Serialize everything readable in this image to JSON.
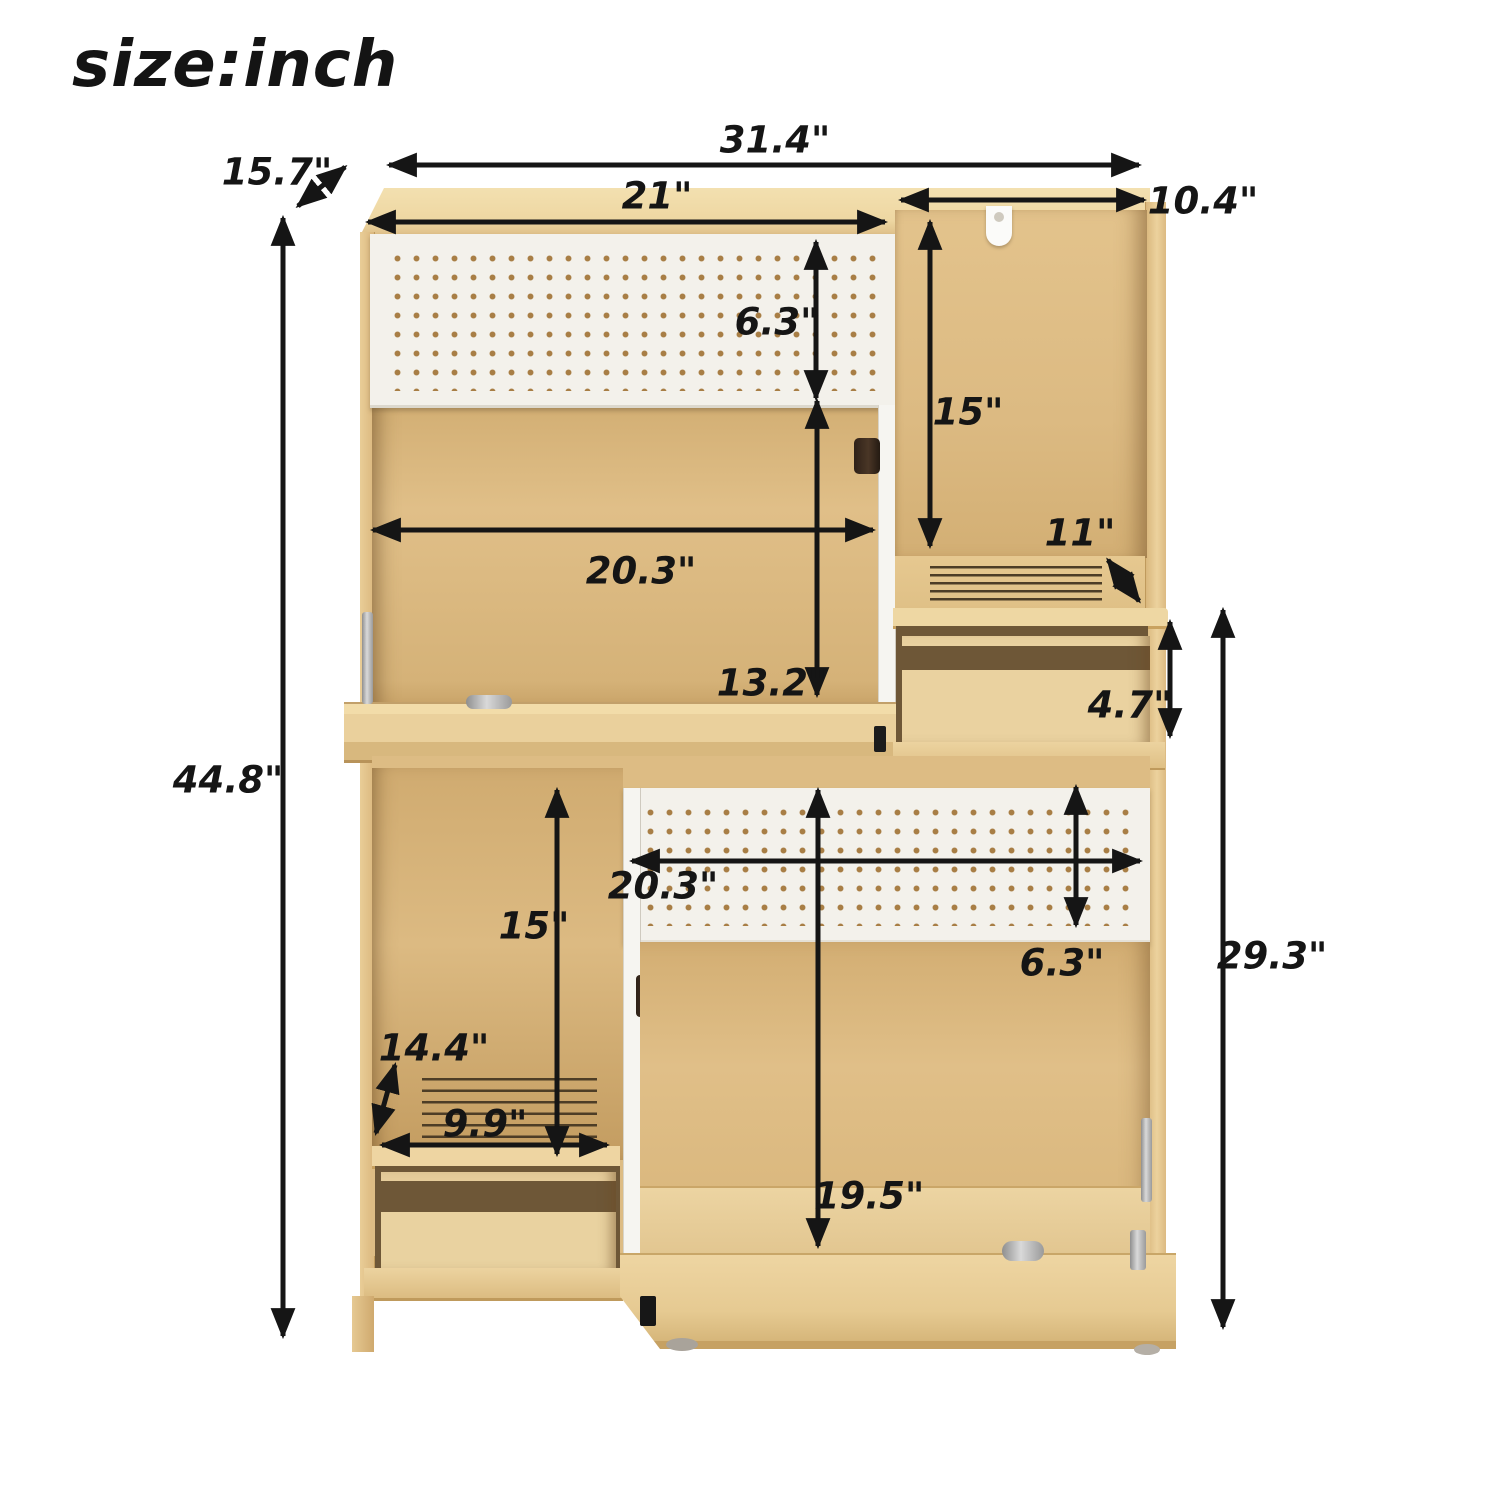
{
  "title": "size:inch",
  "palette": {
    "wood-top": "#f1dca9",
    "wood-face": "#ecd29d",
    "wood-interior": "#dcba83",
    "wood-interior-dark": "#c9a468",
    "wood-drawer-cavity": "#6e5737",
    "pegboard-white": "#f3f1eb",
    "pegboard-dot": "#a87e45",
    "divider-white": "#f6f5f1",
    "arrow-color": "#151515",
    "metal-silver": "#b9b9b9",
    "background": "#ffffff"
  },
  "dimensions": {
    "overall_width": "31.4\"",
    "depth": "15.7\"",
    "hutch_left_width": "21\"",
    "hutch_right_width": "10.4\"",
    "upper_pegboard_height": "6.3\"",
    "upper_right_inner_height": "15\"",
    "upper_inner_width": "20.3\"",
    "right_shelf_depth": "11\"",
    "upper_inner_height": "13.2\"",
    "right_drawer_height": "4.7\"",
    "overall_height": "44.8\"",
    "lower_left_inner_height": "15\"",
    "lower_inner_width": "20.3\"",
    "lower_pegboard_height": "6.3\"",
    "lower_shelf_depth": "14.4\"",
    "lower_shelf_width": "9.9\"",
    "lower_inner_height": "19.5\"",
    "lower_section_height": "29.3\""
  }
}
